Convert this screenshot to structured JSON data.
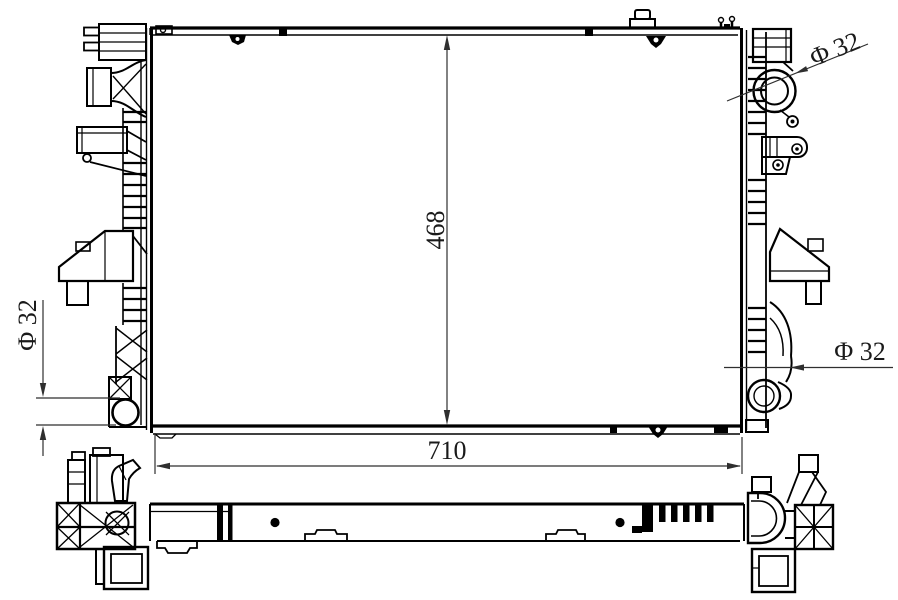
{
  "drawing": {
    "type": "engineering-line-drawing",
    "subject": "radiator",
    "views": {
      "front": "radiator-front-view",
      "bottom": "radiator-bottom-profile-view"
    },
    "colors": {
      "background": "#ffffff",
      "part_line": "#000000",
      "dimension_line": "#2f2f2f"
    },
    "dimensions": {
      "height": {
        "label": "468",
        "value": 468,
        "orientation": "vertical"
      },
      "width": {
        "label": "710",
        "value": 710,
        "orientation": "horizontal"
      },
      "pipe_left": {
        "label": "Φ 32",
        "value": 32,
        "symbol": "diameter"
      },
      "pipe_top_right": {
        "label": "Φ 32",
        "value": 32,
        "symbol": "diameter"
      },
      "pipe_bottom_right": {
        "label": "Φ 32",
        "value": 32,
        "symbol": "diameter"
      }
    }
  }
}
